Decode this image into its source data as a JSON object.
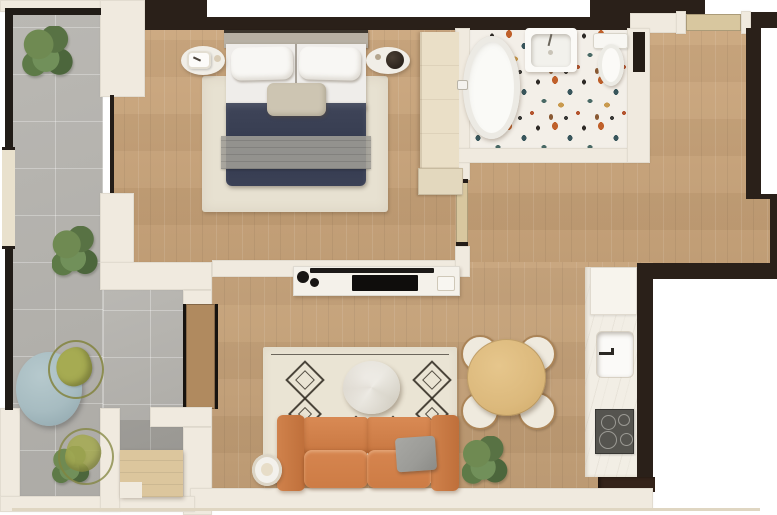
{
  "title": "one-bedroom-apartment-floor-plan",
  "colors": {
    "wall-light": "#f0eadf",
    "wall-dark": "#2a2019",
    "wood-floor": "#c9a378",
    "terrace-tile": "#b6b4af",
    "terrazzo-base": "#f3efe8",
    "counter-white": "#f2eee5",
    "rug-cream": "#e7e1d1",
    "bed-duvet": "#3f4559",
    "bed-blanket": "#a09e97",
    "sofa-orange": "#cd7c45",
    "pillow-gray": "#9b9b97",
    "dining-table-wood": "#dcb97c",
    "chair-olive": "#a6ab52",
    "terrace-table-blue": "#a7bcc1",
    "cooktop-gray": "#55544f",
    "door-tan": "#d8c79f",
    "deck-wood": "#dcc69d",
    "plant-green": "#5f7c46"
  },
  "rooms": [
    {
      "name": "terrace"
    },
    {
      "name": "bedroom"
    },
    {
      "name": "bathroom"
    },
    {
      "name": "hallway"
    },
    {
      "name": "living-dining-room"
    },
    {
      "name": "kitchen"
    }
  ],
  "items": [
    {
      "name": "double-bed"
    },
    {
      "name": "bedroom-rug"
    },
    {
      "name": "nightstand-left"
    },
    {
      "name": "table-lamp"
    },
    {
      "name": "nightstand-right"
    },
    {
      "name": "wardrobe"
    },
    {
      "name": "dresser"
    },
    {
      "name": "bathtub"
    },
    {
      "name": "vanity-sink"
    },
    {
      "name": "toilet"
    },
    {
      "name": "tv-console"
    },
    {
      "name": "tv"
    },
    {
      "name": "sofa"
    },
    {
      "name": "sofa-pillow"
    },
    {
      "name": "living-rug"
    },
    {
      "name": "coffee-table"
    },
    {
      "name": "side-table"
    },
    {
      "name": "dining-table"
    },
    {
      "name": "dining-chair",
      "count": 4
    },
    {
      "name": "kitchen-counter"
    },
    {
      "name": "kitchen-sink"
    },
    {
      "name": "cooktop"
    },
    {
      "name": "terrace-table"
    },
    {
      "name": "terrace-chair",
      "count": 2
    },
    {
      "name": "plant",
      "count": 5
    },
    {
      "name": "sliding-door"
    },
    {
      "name": "bedroom-door"
    },
    {
      "name": "entrance-door"
    },
    {
      "name": "deck-steps"
    },
    {
      "name": "railing"
    }
  ]
}
